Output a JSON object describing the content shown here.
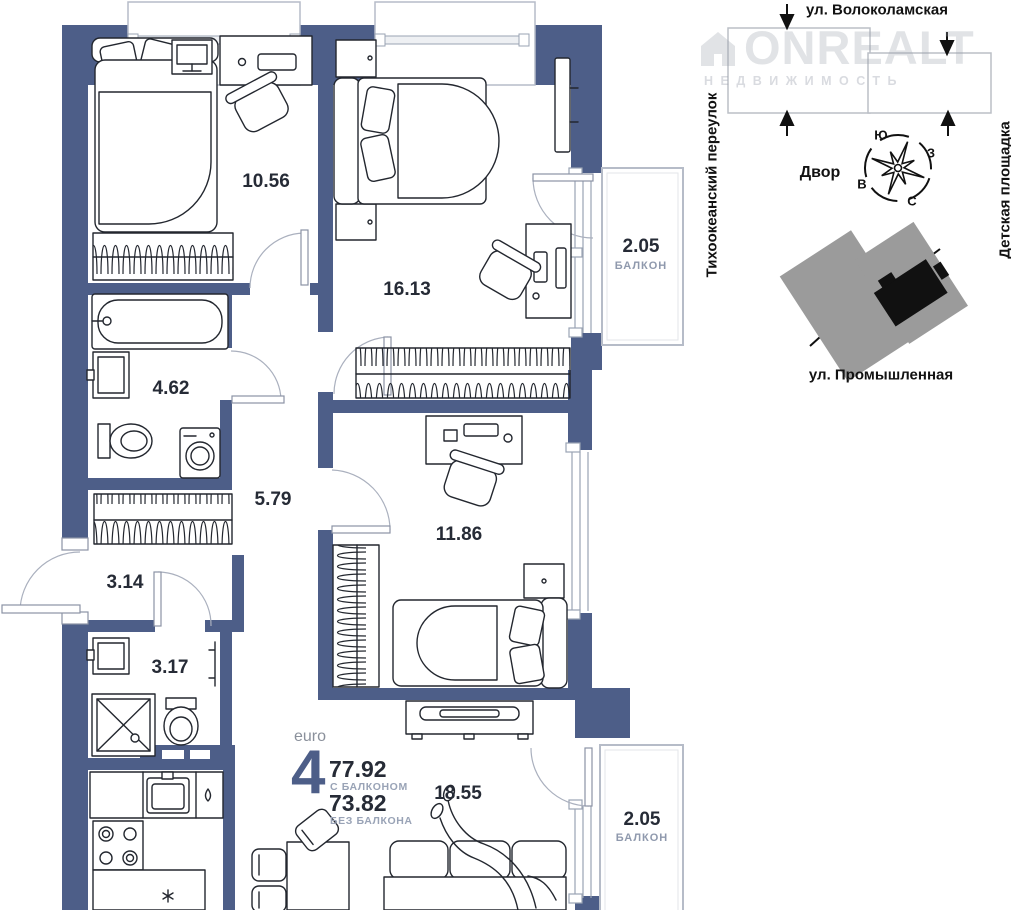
{
  "plan": {
    "rooms": {
      "bedroom1": "10.56",
      "bedroom2": "16.13",
      "bedroom3": "11.86",
      "bathroom1": "4.62",
      "hallway": "5.79",
      "entry": "3.14",
      "bathroom2": "3.17",
      "living_kitchen": "18.55"
    },
    "balconies": {
      "top": {
        "area": "2.05",
        "label": "БАЛКОН"
      },
      "bottom": {
        "area": "2.05",
        "label": "БАЛКОН"
      }
    }
  },
  "summary": {
    "layout_type": "euro",
    "rooms_count": "4",
    "area_with_balcony": "77.92",
    "area_with_balcony_label": "С БАЛКОНОМ",
    "area_without_balcony": "73.82",
    "area_without_balcony_label": "БЕЗ БАЛКОНА"
  },
  "site_plan": {
    "street_top": "ул. Волоколамская",
    "lane_left": "Тихоокеанский переулок",
    "area_right": "Детская площадка",
    "courtyard": "Двор",
    "street_bottom": "ул. Промышленная",
    "compass": {
      "top": "Ю",
      "right": "З",
      "left": "В",
      "bottom": "С"
    }
  },
  "watermark": {
    "brand": "ONREALT",
    "tagline": "НЕДВИЖИМОСТЬ"
  },
  "colors": {
    "walls": "#4d5e88",
    "accent_number": "#4d5e88",
    "text_dark": "#262b36",
    "text_muted": "#99a3b6",
    "site_building_gray": "#9b9b9b",
    "site_building_black": "#111111"
  }
}
